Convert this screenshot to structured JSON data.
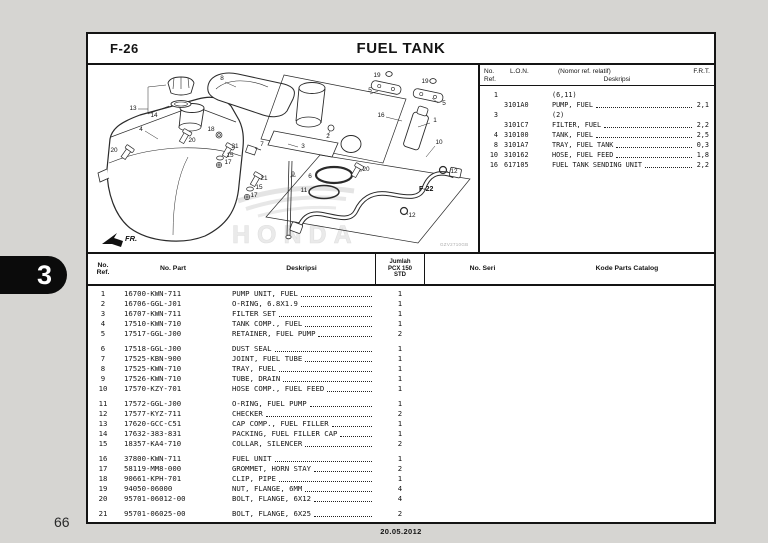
{
  "page": {
    "section_code": "F-26",
    "title": "FUEL TANK",
    "chapter_tab": "3",
    "page_number": "66",
    "date": "20.05.2012"
  },
  "ref_table": {
    "headers": {
      "ref": "No.\nRef.",
      "lon": "L.O.N.",
      "desc_note": "(Nomor ref. relatif)",
      "desc": "Deskripsi",
      "frt": "F.R.T."
    },
    "rows": [
      {
        "ref": "1",
        "lon": "",
        "desc": "(6,11)",
        "frt": ""
      },
      {
        "ref": "",
        "lon": "3101A0",
        "desc": "PUMP, FUEL",
        "frt": "2,1"
      },
      {
        "ref": "3",
        "lon": "",
        "desc": "(2)",
        "frt": ""
      },
      {
        "ref": "",
        "lon": "3101C7",
        "desc": "FILTER, FUEL",
        "frt": "2,2"
      },
      {
        "ref": "4",
        "lon": "310100",
        "desc": "TANK, FUEL",
        "frt": "2,5"
      },
      {
        "ref": "8",
        "lon": "3101A7",
        "desc": "TRAY, FUEL TANK",
        "frt": "0,3"
      },
      {
        "ref": "10",
        "lon": "310162",
        "desc": "HOSE, FUEL FEED",
        "frt": "1,8"
      },
      {
        "ref": "16",
        "lon": "617105",
        "desc": "FUEL TANK SENDING UNIT",
        "frt": "2,2"
      }
    ]
  },
  "parts_table": {
    "headers": {
      "ref": "No.\nRef.",
      "part": "No. Part",
      "desc": "Deskripsi",
      "qty": "Jumlah\nPCX 150\nSTD",
      "seri": "No. Seri",
      "catalog": "Kode Parts Catalog"
    },
    "rows": [
      {
        "ref": "1",
        "part": "16700-KWN-711",
        "desc": "PUMP UNIT, FUEL",
        "qty": "1"
      },
      {
        "ref": "2",
        "part": "16706-GGL-J01",
        "desc": "O-RING, 6.8X1.9",
        "qty": "1"
      },
      {
        "ref": "3",
        "part": "16707-KWN-711",
        "desc": "FILTER SET",
        "qty": "1"
      },
      {
        "ref": "4",
        "part": "17510-KWN-710",
        "desc": "TANK COMP., FUEL",
        "qty": "1"
      },
      {
        "ref": "5",
        "part": "17517-GGL-J00",
        "desc": "RETAINER, FUEL PUMP",
        "qty": "2"
      },
      {
        "ref": "6",
        "part": "17518-GGL-J00",
        "desc": "DUST SEAL",
        "qty": "1"
      },
      {
        "ref": "7",
        "part": "17525-KBN-900",
        "desc": "JOINT, FUEL TUBE",
        "qty": "1"
      },
      {
        "ref": "8",
        "part": "17525-KWN-710",
        "desc": "TRAY, FUEL",
        "qty": "1"
      },
      {
        "ref": "9",
        "part": "17526-KWN-710",
        "desc": "TUBE, DRAIN",
        "qty": "1"
      },
      {
        "ref": "10",
        "part": "17570-KZY-701",
        "desc": "HOSE COMP., FUEL FEED",
        "qty": "1"
      },
      {
        "ref": "11",
        "part": "17572-GGL-J00",
        "desc": "O-RING, FUEL PUMP",
        "qty": "1"
      },
      {
        "ref": "12",
        "part": "17577-KYZ-711",
        "desc": "CHECKER",
        "qty": "2"
      },
      {
        "ref": "13",
        "part": "17620-GCC-C51",
        "desc": "CAP COMP., FUEL FILLER",
        "qty": "1"
      },
      {
        "ref": "14",
        "part": "17632-383-831",
        "desc": "PACKING, FUEL FILLER CAP",
        "qty": "1"
      },
      {
        "ref": "15",
        "part": "18357-KA4-710",
        "desc": "COLLAR, SILENCER",
        "qty": "2"
      },
      {
        "ref": "16",
        "part": "37800-KWN-711",
        "desc": "FUEL UNIT",
        "qty": "1"
      },
      {
        "ref": "17",
        "part": "58119-MM8-000",
        "desc": "GROMMET, HORN STAY",
        "qty": "2"
      },
      {
        "ref": "18",
        "part": "90661-KPH-701",
        "desc": "CLIP, PIPE",
        "qty": "1"
      },
      {
        "ref": "19",
        "part": "94050-06000",
        "desc": "NUT, FLANGE, 6MM",
        "qty": "4"
      },
      {
        "ref": "20",
        "part": "95701-06012-00",
        "desc": "BOLT, FLANGE, 6X12",
        "qty": "4"
      },
      {
        "ref": "21",
        "part": "95701-06025-00",
        "desc": "BOLT, FLANGE, 6X25",
        "qty": "2"
      }
    ]
  },
  "diagram": {
    "direction_label": "FR.",
    "link_label": "F-22",
    "watermark": "HONDA",
    "figure_code": "GZV2710GB",
    "callouts": [
      {
        "label": "8",
        "x": 134,
        "y": 15
      },
      {
        "label": "19",
        "x": 289,
        "y": 12
      },
      {
        "label": "19",
        "x": 337,
        "y": 18
      },
      {
        "label": "5",
        "x": 282,
        "y": 27
      },
      {
        "label": "5",
        "x": 356,
        "y": 40
      },
      {
        "label": "13",
        "x": 45,
        "y": 45
      },
      {
        "label": "14",
        "x": 66,
        "y": 52
      },
      {
        "label": "16",
        "x": 293,
        "y": 52
      },
      {
        "label": "1",
        "x": 347,
        "y": 57
      },
      {
        "label": "4",
        "x": 53,
        "y": 66
      },
      {
        "label": "18",
        "x": 123,
        "y": 66
      },
      {
        "label": "2",
        "x": 240,
        "y": 73
      },
      {
        "label": "20",
        "x": 104,
        "y": 77
      },
      {
        "label": "10",
        "x": 351,
        "y": 79
      },
      {
        "label": "7",
        "x": 174,
        "y": 81
      },
      {
        "label": "3",
        "x": 215,
        "y": 83
      },
      {
        "label": "21",
        "x": 147,
        "y": 83
      },
      {
        "label": "20",
        "x": 26,
        "y": 87
      },
      {
        "label": "15",
        "x": 142,
        "y": 92
      },
      {
        "label": "17",
        "x": 140,
        "y": 99
      },
      {
        "label": "20",
        "x": 278,
        "y": 106
      },
      {
        "label": "12",
        "x": 366,
        "y": 108
      },
      {
        "label": "9",
        "x": 205,
        "y": 111
      },
      {
        "label": "6",
        "x": 222,
        "y": 113
      },
      {
        "label": "21",
        "x": 176,
        "y": 115
      },
      {
        "label": "15",
        "x": 171,
        "y": 124
      },
      {
        "label": "11",
        "x": 216,
        "y": 127
      },
      {
        "label": "17",
        "x": 166,
        "y": 132
      },
      {
        "label": "12",
        "x": 324,
        "y": 152
      }
    ]
  }
}
